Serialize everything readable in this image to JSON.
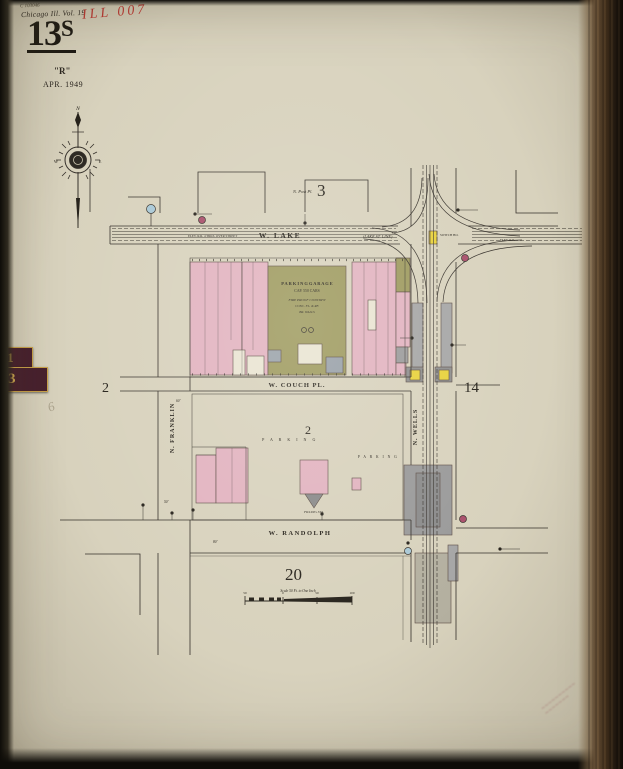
{
  "header": {
    "catalog": "C 103046",
    "volume": "Chicago Ill. Vol. 19",
    "accession": "ILL 007",
    "sheet_number": "13",
    "sheet_suffix": "S",
    "series": "\"R\"",
    "date": "APR. 1949"
  },
  "tabs": {
    "upper": "1",
    "lower": "3",
    "pencil_note": "6"
  },
  "compass": {
    "north": "N",
    "west": "W",
    "east": "E"
  },
  "streets": {
    "lake": "W.   LAKE",
    "couch": "W.   COUCH   PL.",
    "randolph": "W.   RANDOLPH",
    "franklin": "N.  FRANKLIN",
    "wells": "N.  WELLS",
    "post_place": "N. Post Pl."
  },
  "adjacent_sheets": {
    "north": "3",
    "west": "2",
    "east": "14",
    "south": "20"
  },
  "block_number": "2",
  "garage": {
    "l1": "P A R K I N G     G A R A G E",
    "l2": "CAP. 550 CARS",
    "l3": "FIRE PROOF CONSTR'N",
    "l4": "CONC. FL. & RF.",
    "l5": "BR. WALLS"
  },
  "annotations": {
    "parking_a": "P  A  R  K  I  N  G",
    "parking_b": "P A R K I N G",
    "switch_house": "SWITCH HO.",
    "filling_station": "FILLING STA.",
    "el_note_west": "ELEV. R.R. 4 TRKS. OVER STREET",
    "el_note_east": "ELEV. R.R.",
    "lake_note": "(LAKE ST. LINE)",
    "width_couch": "60'",
    "width_randolph": "80'",
    "width_franklin": "50'"
  },
  "scale_bar": {
    "label": "Scale 50 Ft. to One Inch",
    "tick_left": "50",
    "tick_zero": "0",
    "tick_mid": "50",
    "tick_right": "100"
  },
  "stamp": {
    "line1": "~~~~~~~~~~",
    "line2": "~~~~~~~"
  },
  "colors": {
    "page": "#d8d2bd",
    "building_pink": "#e2b3c0",
    "building_olive": "#9e9a5f",
    "station_yellow": "#e8d23c",
    "structure_gray": "#9c9c9c",
    "symbol_blue": "#a9c8d6",
    "symbol_magenta": "#a94f6b",
    "tab_maroon": "#47202e",
    "tab_gold": "#d9b054",
    "red_ink": "#c23a35",
    "line_ink": "#35302a"
  }
}
